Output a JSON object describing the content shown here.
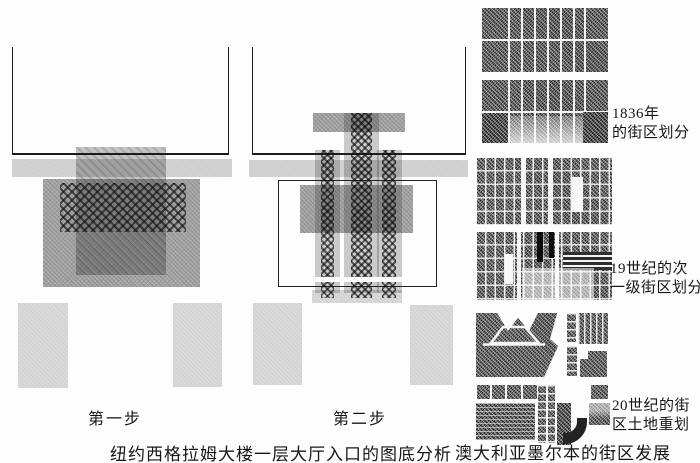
{
  "captions": {
    "step1": "第一步",
    "step2": "第二步",
    "left_figure": "纽约西格拉姆大楼一层大厅入口的图底分析",
    "right_figure": "澳大利亚墨尔本的街区发展"
  },
  "right_labels": {
    "y1836": {
      "line1": "1836年",
      "line2": "的街区划分"
    },
    "c19th": {
      "line1": "19世纪的次",
      "line2": "一级街区划分"
    },
    "c20th": {
      "line1": "20世纪的街",
      "line2": "区土地重划"
    }
  },
  "colors": {
    "paper": "#fdfdfd",
    "light_gray": "#d7d7d7",
    "mid_gray": "#a4a4a4",
    "dark_ink": "#2f2f2f",
    "outline": "#1c1c1c"
  }
}
